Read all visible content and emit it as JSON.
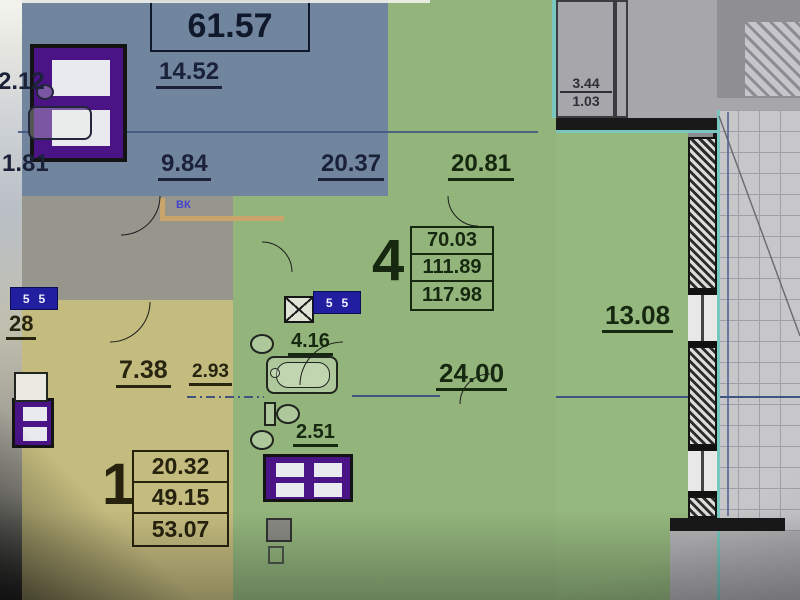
{
  "labels": {
    "apt_top_table": "61.57",
    "blue_14_52": "14.52",
    "blue_2_12": "2.12",
    "blue_1_81": "1.81",
    "blue_9_84": "9.84",
    "blue_20_37": "20.37",
    "green_20_81": "20.81",
    "balcony_3_44": "3.44",
    "balcony_1_03": "1.03",
    "apt4_num": "4",
    "apt4_row1": "70.03",
    "apt4_row2": "111.89",
    "apt4_row3": "117.98",
    "green_13_08": "13.08",
    "green_24_00": "24.00",
    "bath_4_16": "4.16",
    "wc_2_51": "2.51",
    "yellow_28": "28",
    "yellow_7_38": "7.38",
    "yellow_2_93": "2.93",
    "apt1_num": "1",
    "apt1_row1": "20.32",
    "apt1_row2": "49.15",
    "apt1_row3": "53.07",
    "vk_label": "ВК",
    "badge_left": "55",
    "badge_bath": "55"
  },
  "colors": {
    "blue_room": "#71869e",
    "green_room": "#93b57c",
    "yellow_room": "#c4bb7e",
    "gray_area": "#a7a7ab",
    "wall": "#191919",
    "furniture_purple": "#4a1487",
    "badge_blue": "#211fa0",
    "teal_edge": "#79c7bf",
    "duct_tan": "#c9a56b",
    "blue_text": "#1a2138",
    "green_text": "#16280f",
    "yellow_text": "#27240f"
  }
}
